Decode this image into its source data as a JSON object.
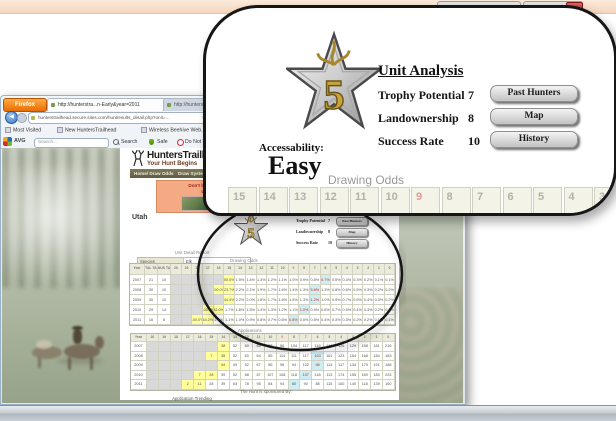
{
  "taskbar": {
    "time": "3:04 PM",
    "date": "11/3/2012"
  },
  "browser": {
    "menu_button": "Firefox",
    "tabs": [
      {
        "title": "http://hunterstra...n-Early&year=2011",
        "close": "x"
      },
      {
        "title": "http://hunterstra...s.php?PARENT=28..."
      },
      {
        "title": "http://..."
      }
    ],
    "back_glyph": "◀",
    "url": "hunterstrailhead.secure.sites.com/huntresults_detail.php?unit=...",
    "bookmark_star": "☆",
    "bookmarks": [
      "Most Visited",
      "New HuntersTrailhead",
      "Wireless Beehive Web...",
      "HuntersTrailhead Ho...",
      "MyMail Trailhead"
    ],
    "avg": {
      "brand": "AVG",
      "search_value": "Search...",
      "actions": [
        "Search",
        "Safe",
        "Do Not Track"
      ]
    }
  },
  "site": {
    "name": "HuntersTrailhead",
    "tagline": "Your Hunt Begins",
    "nav": [
      "Home/ Draw Odds",
      "Draw Systems",
      "Outfitters"
    ],
    "ad_line1": "Don't book the wrong outfitter!",
    "ad_line2": "Use NextHunt first.",
    "state": "Utah",
    "sponsored": "The Hunt is sponsored By:",
    "trending": "Application Trending"
  },
  "unit_detail": {
    "title": "Unit Detail Report",
    "rows": [
      {
        "label": "Species",
        "value": "Elk",
        "highlight": false
      },
      {
        "label": "Unit",
        "value": "Monroe (Early)",
        "highlight": false
      },
      {
        "label": "Weapon",
        "value": "Any Weapon",
        "highlight": false
      },
      {
        "label": "Resident Status",
        "value": "Resident",
        "highlight": false
      },
      {
        "label": "2011 Points",
        "value": "0",
        "highlight": true
      },
      {
        "label": "Current Points",
        "value": "18",
        "highlight": true
      }
    ]
  },
  "unit_analysis": {
    "star_value": "5",
    "accessibility_label": "Accessability:",
    "accessibility_value": "Easy",
    "title": "Unit Analysis",
    "metrics": [
      {
        "label": "Trophy Potential",
        "value": "7",
        "button": "Past Hunters"
      },
      {
        "label": "Landownership",
        "value": "8",
        "button": "Map"
      },
      {
        "label": "Success Rate",
        "value": "10",
        "button": "History"
      }
    ]
  },
  "callout": {
    "drawing_odds_title": "Drawing Odds",
    "header_cells": [
      "15",
      "14",
      "13",
      "12",
      "11",
      "10",
      "9",
      "8",
      "7",
      "6",
      "5",
      "4",
      "3"
    ],
    "red_cell": "9"
  },
  "drawing_odds": {
    "title": "Drawing Odds",
    "headers": [
      "Year",
      "TOTAL TAGS",
      "BONUS TAGS",
      "20",
      "19",
      "18",
      "17",
      "16",
      "15",
      "14",
      "13",
      "12",
      "11",
      "10",
      "9",
      "8",
      "7",
      "6",
      "5",
      "4",
      "3",
      "2",
      "1",
      "0"
    ],
    "red_header": "9",
    "rows": [
      {
        "year": "2007",
        "total": "21",
        "bonus": "10",
        "cells": [
          "g:",
          "g:",
          "g:",
          "g:",
          "g:",
          "y:50.0%",
          ":1.5%",
          ":1.4%",
          ":1.3%",
          ":1.2%",
          ":1.1%",
          ":1.0%",
          ":0.9%",
          ":0.8%",
          "rb:0.7%",
          ":0.5%",
          ":0.4%",
          ":0.3%",
          ":0.2%",
          ":0.1%",
          ":0.1%"
        ]
      },
      {
        "year": "2008",
        "total": "30",
        "bonus": "10",
        "cells": [
          "g:",
          "g:",
          "g:",
          "g:",
          "y:100.0%",
          "y:23.7%",
          ":2.2%",
          ":2.1%",
          ":1.9%",
          ":1.7%",
          ":1.6%",
          ":1.4%",
          ":1.3%",
          "rb:5.8%",
          ":1.3%",
          ":0.8%",
          ":0.6%",
          ":0.5%",
          ":0.3%",
          ":0.2%",
          ":0.2%"
        ]
      },
      {
        "year": "2009",
        "total": "30",
        "bonus": "10",
        "cells": [
          "g:",
          "g:",
          "g:",
          "g:",
          "g:",
          "y:44.4%",
          ":2.2%",
          ":2.0%",
          ":1.8%",
          ":1.7%",
          ":1.6%",
          ":1.5%",
          ":1.3%",
          "rb:1.2%",
          ":1.0%",
          ":0.9%",
          ":0.7%",
          ":0.5%",
          ":0.4%",
          ":0.3%",
          ":0.2%"
        ]
      },
      {
        "year": "2010",
        "total": "29",
        "bonus": "14",
        "cells": [
          "g:",
          "g:",
          "g:",
          "y:100.0%",
          "y:52.0%",
          ":1.7%",
          ":1.6%",
          ":1.5%",
          ":1.4%",
          ":1.3%",
          ":1.2%",
          ":1.1%",
          "rb:1.0%",
          ":0.9%",
          ":0.8%",
          ":0.7%",
          ":0.5%",
          ":0.4%",
          ":0.3%",
          ":0.2%",
          ":0.2%"
        ]
      },
      {
        "year": "2011",
        "total": "16",
        "bonus": "8",
        "cells": [
          "g:",
          "g:",
          "y:100.0%",
          "y:54.2%",
          ":1.7%",
          ":1.1%",
          ":1.0%",
          ":0.9%",
          ":0.8%",
          ":0.7%",
          ":0.6%",
          "rb:0.8%",
          ":0.5%",
          ":0.5%",
          ":0.4%",
          ":0.3%",
          ":0.3%",
          ":0.2%",
          ":0.2%",
          ":0.1%",
          ":0.1%"
        ]
      }
    ]
  },
  "applications": {
    "title": "Applications",
    "headers": [
      "Year",
      "20",
      "19",
      "18",
      "17",
      "16",
      "15",
      "14",
      "13",
      "12",
      "11",
      "10",
      "9",
      "8",
      "7",
      "6",
      "5",
      "4",
      "3",
      "2",
      "1",
      "0"
    ],
    "red_header": "9",
    "rows": [
      {
        "year": "2007",
        "cells": [
          "g:",
          "g:",
          "g:",
          "g:",
          "g:",
          "g:",
          "y:38",
          ":52",
          ":60",
          ":66",
          ":78",
          ":90",
          ":104",
          ":117",
          ":116",
          "r:144",
          ":126",
          ":129",
          ":158",
          ":181",
          ":216"
        ]
      },
      {
        "year": "2008",
        "cells": [
          "g:",
          "g:",
          "g:",
          "g:",
          "g:",
          "y:7",
          "y:38",
          ":52",
          ":60",
          ":64",
          ":85",
          ":114",
          ":111",
          ":117",
          "rb:163",
          ":161",
          ":123",
          ":154",
          ":168",
          ":184",
          ":183"
        ]
      },
      {
        "year": "2009",
        "cells": [
          "g:",
          "g:",
          "g:",
          "g:",
          "g:",
          "g:",
          "y:94",
          ":49",
          ":52",
          ":67",
          ":86",
          ":96",
          ":94",
          ":102",
          "rb:98",
          ":114",
          ":117",
          ":134",
          ":175",
          ":191",
          ":188"
        ]
      },
      {
        "year": "2010",
        "cells": [
          "g:",
          "g:",
          "g:",
          "g:",
          "y:7",
          "y:28",
          ":39",
          ":52",
          ":68",
          ":87",
          ":107",
          ":108",
          ":118",
          "rb:107",
          ":118",
          ":113",
          ":174",
          ":155",
          ":169",
          ":183",
          ":225"
        ]
      },
      {
        "year": "2011",
        "cells": [
          "g:",
          "g:",
          "g:",
          "y:2",
          "y:11",
          ":28",
          ":39",
          ":63",
          ":78",
          ":95",
          ":84",
          ":94",
          "b:80",
          ":90",
          ":88",
          ":115",
          ":100",
          ":140",
          ":118",
          ":139",
          ":160"
        ]
      }
    ]
  }
}
